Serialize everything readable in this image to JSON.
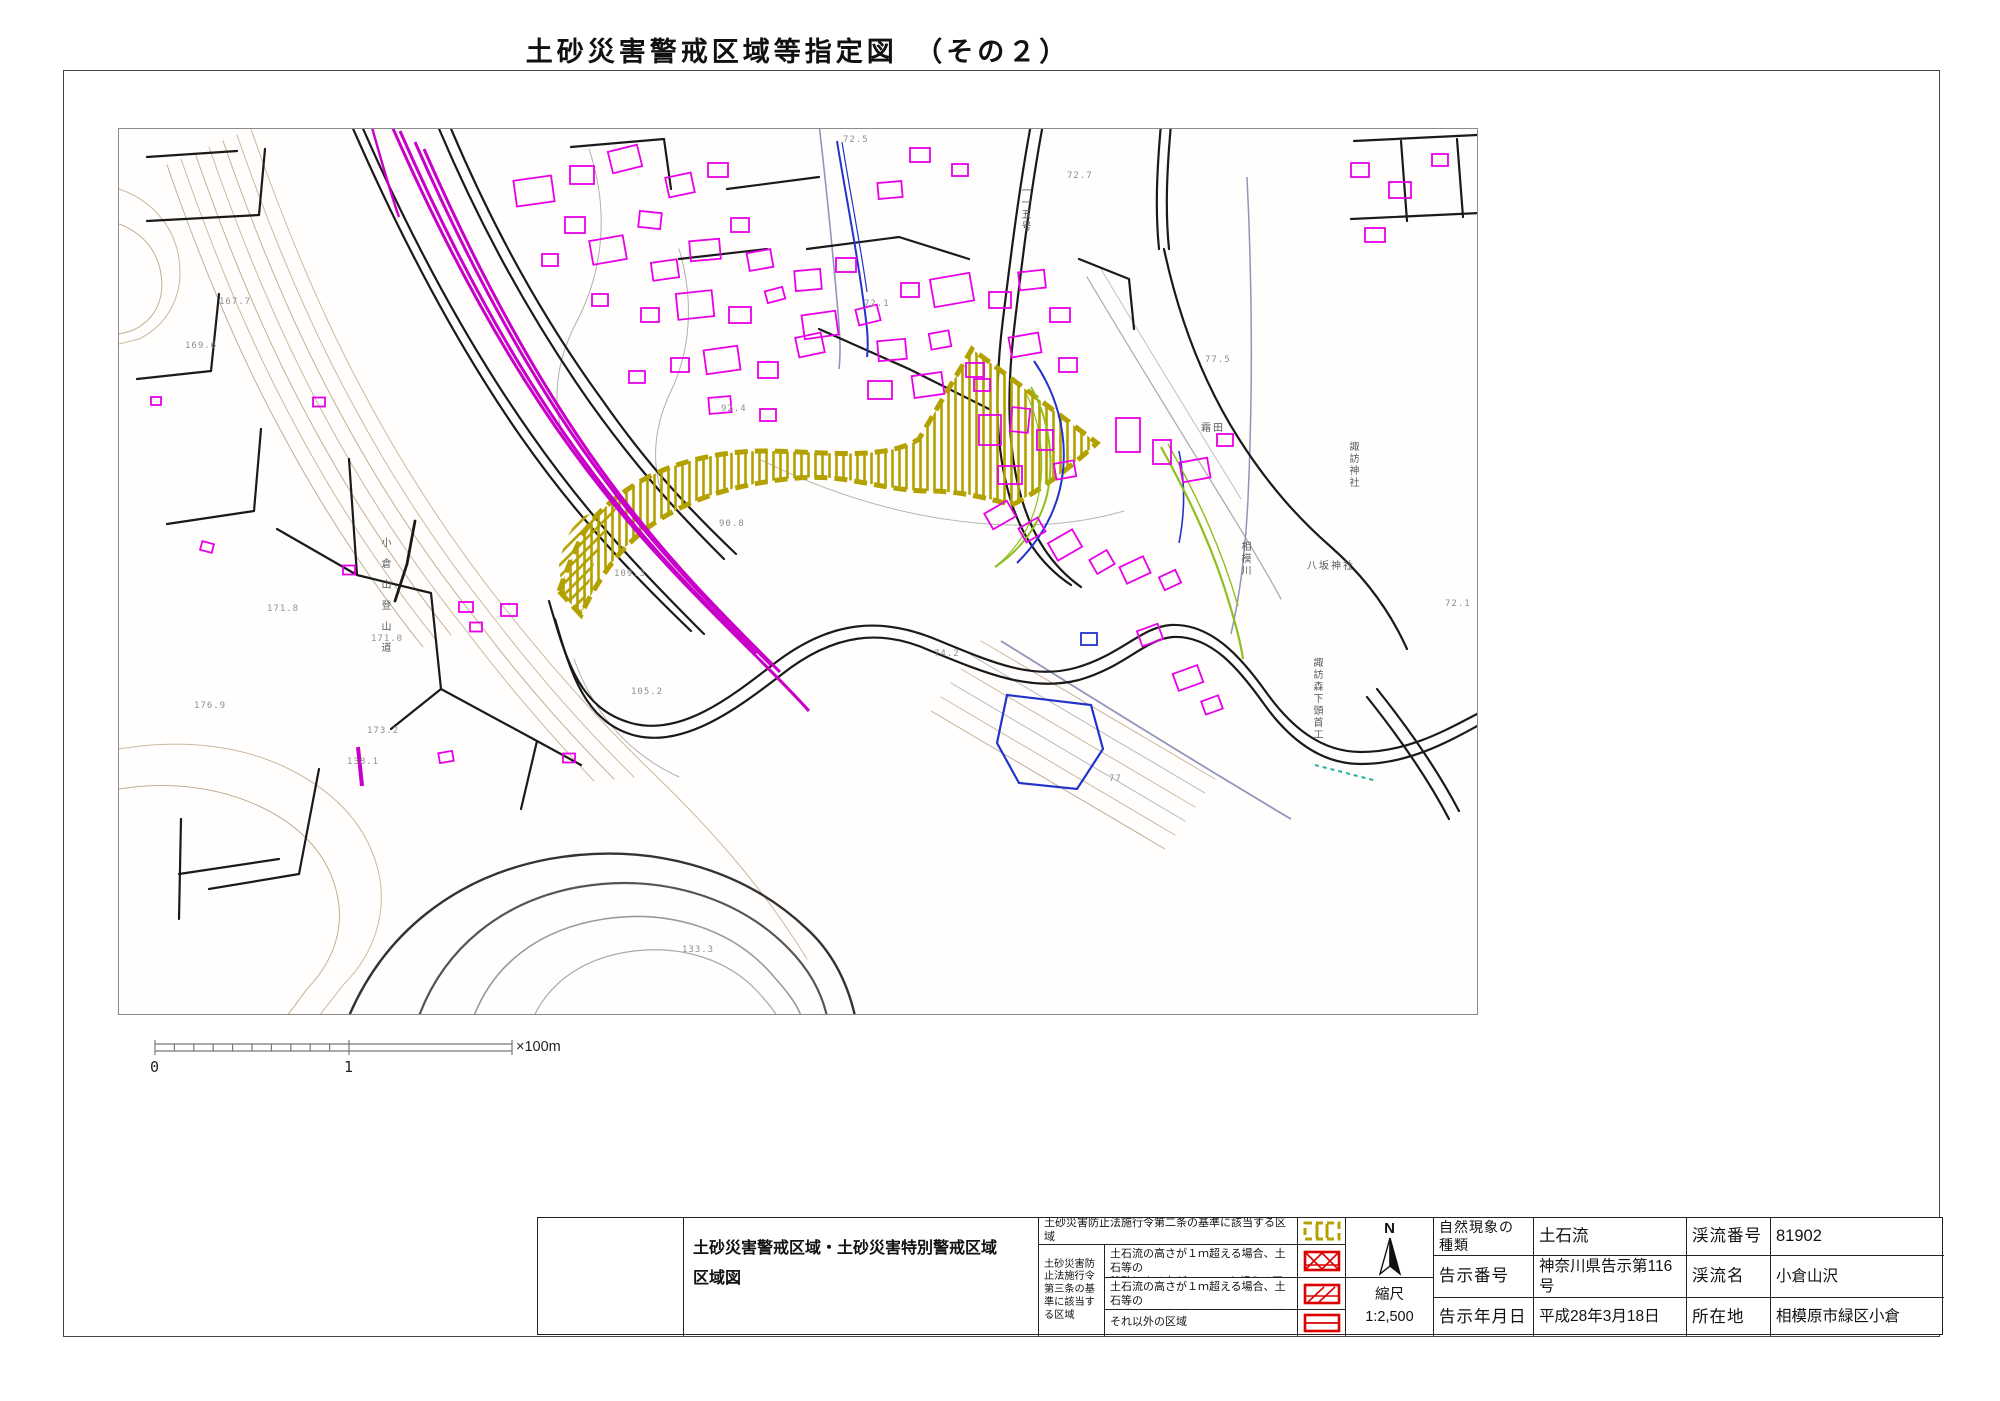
{
  "page": {
    "title": "土砂災害警戒区域等指定図　（その２）"
  },
  "scalebar": {
    "zero": "0",
    "one": "1",
    "unit": "×100m"
  },
  "legend": {
    "doc_title_line1": "土砂災害警戒区域・土砂災害特別警戒区域",
    "doc_title_line2": "区域図",
    "row1": "土砂災害防止法施行令第二条の基準に該当する区域",
    "group": "土砂災害防止法施行令第三条の基準に該当する区域",
    "row2_line1": "土石流の高さが１ｍ超える場合、土石等の",
    "row2_line2": "移動による力が50kN/m²を超える区域",
    "row3_line1": "土石流の高さが１ｍ超える場合、土石等の",
    "row3_line2": "移動による力が50kN/m²以下の区域",
    "row4": "それ以外の区域",
    "swatch_colors": {
      "warning": "#b3a100",
      "special": "#dd0000"
    }
  },
  "compass": {
    "label": "N"
  },
  "scale": {
    "label": "縮尺",
    "value": "1:2,500"
  },
  "info": {
    "r1c1": "自然現象の種類",
    "r1c2": "土石流",
    "r1c3": "渓流番号",
    "r1c4": "81902",
    "r2c1": "告示番号",
    "r2c2": "神奈川県告示第116号",
    "r2c3": "渓流名",
    "r2c4": "小倉山沢",
    "r3c1": "告示年月日",
    "r3c2": "平成28年3月18日",
    "r3c3": "所在地",
    "r3c4": "相模原市緑区小倉"
  },
  "map": {
    "colors": {
      "building": "#e800e8",
      "railway": "#c800c8",
      "hazard": "#b3a100",
      "road": "#1a1a1a",
      "water": "#2233cc",
      "green": "#8fbf1f",
      "contour_tan": "#ccb89e",
      "contour_gray": "#b0b0b0"
    },
    "labels": [
      {
        "t": "167.7",
        "x": 100,
        "y": 168
      },
      {
        "t": "169.6",
        "x": 66,
        "y": 212
      },
      {
        "t": "171.8",
        "x": 148,
        "y": 475
      },
      {
        "t": "171.0",
        "x": 252,
        "y": 505
      },
      {
        "t": "173.2",
        "x": 248,
        "y": 597
      },
      {
        "t": "176.9",
        "x": 75,
        "y": 572
      },
      {
        "t": "138.1",
        "x": 228,
        "y": 628
      },
      {
        "t": "133.3",
        "x": 563,
        "y": 816
      },
      {
        "t": "109.3",
        "x": 495,
        "y": 440
      },
      {
        "t": "105.2",
        "x": 512,
        "y": 558
      },
      {
        "t": "92.4",
        "x": 602,
        "y": 275
      },
      {
        "t": "90.8",
        "x": 600,
        "y": 390
      },
      {
        "t": "74.2",
        "x": 815,
        "y": 520
      },
      {
        "t": "72.1",
        "x": 745,
        "y": 170
      },
      {
        "t": "72.5",
        "x": 724,
        "y": 6
      },
      {
        "t": "72.7",
        "x": 948,
        "y": 42
      },
      {
        "t": "77.5",
        "x": 1086,
        "y": 226
      },
      {
        "t": "72.1",
        "x": 1326,
        "y": 470
      },
      {
        "t": "77",
        "x": 990,
        "y": 645
      },
      {
        "t": "霜田",
        "x": 1082,
        "y": 290,
        "place": 1
      },
      {
        "t": "八坂神社",
        "x": 1188,
        "y": 428,
        "place": 1
      },
      {
        "t": "諏訪神社",
        "x": 1226,
        "y": 312,
        "place": 1,
        "v": 1
      },
      {
        "t": "相模川",
        "x": 1118,
        "y": 412,
        "place": 1,
        "v": 1
      },
      {
        "t": "諏訪森下頭首工",
        "x": 1190,
        "y": 528,
        "place": 1,
        "v": 1
      },
      {
        "t": "小倉山登山道",
        "x": 258,
        "y": 408,
        "place": 1,
        "v": 1,
        "spread": 1
      },
      {
        "t": "一一五号",
        "x": 898,
        "y": 56,
        "place": 1,
        "v": 1
      }
    ],
    "buildings": [
      [
        415,
        62,
        38,
        26,
        -8
      ],
      [
        463,
        46,
        24,
        18,
        0
      ],
      [
        506,
        30,
        30,
        22,
        -14
      ],
      [
        456,
        96,
        20,
        16,
        0
      ],
      [
        489,
        121,
        34,
        24,
        -10
      ],
      [
        531,
        91,
        22,
        16,
        6
      ],
      [
        561,
        56,
        26,
        20,
        -12
      ],
      [
        599,
        41,
        20,
        14,
        0
      ],
      [
        546,
        141,
        26,
        18,
        -8
      ],
      [
        586,
        121,
        30,
        20,
        -5
      ],
      [
        621,
        96,
        18,
        14,
        0
      ],
      [
        641,
        131,
        24,
        18,
        -10
      ],
      [
        576,
        176,
        36,
        26,
        -6
      ],
      [
        621,
        186,
        22,
        16,
        0
      ],
      [
        656,
        166,
        18,
        12,
        -15
      ],
      [
        531,
        186,
        18,
        14,
        0
      ],
      [
        481,
        171,
        16,
        12,
        0
      ],
      [
        431,
        131,
        16,
        12,
        0
      ],
      [
        603,
        231,
        34,
        24,
        -8
      ],
      [
        649,
        241,
        20,
        16,
        0
      ],
      [
        691,
        216,
        26,
        20,
        -12
      ],
      [
        561,
        236,
        18,
        14,
        0
      ],
      [
        601,
        276,
        22,
        16,
        -5
      ],
      [
        649,
        286,
        16,
        12,
        0
      ],
      [
        518,
        248,
        16,
        12,
        0
      ],
      [
        689,
        151,
        26,
        20,
        -5
      ],
      [
        727,
        136,
        20,
        14,
        0
      ],
      [
        701,
        196,
        34,
        24,
        -8
      ],
      [
        749,
        186,
        22,
        16,
        -14
      ],
      [
        791,
        161,
        18,
        14,
        0
      ],
      [
        773,
        221,
        28,
        20,
        -5
      ],
      [
        821,
        211,
        20,
        16,
        -10
      ],
      [
        761,
        261,
        24,
        18,
        0
      ],
      [
        809,
        256,
        30,
        22,
        -8
      ],
      [
        856,
        241,
        18,
        14,
        0
      ],
      [
        833,
        161,
        40,
        28,
        -10
      ],
      [
        881,
        171,
        22,
        16,
        0
      ],
      [
        913,
        151,
        26,
        18,
        -6
      ],
      [
        941,
        186,
        20,
        14,
        0
      ],
      [
        906,
        216,
        30,
        20,
        -10
      ],
      [
        949,
        236,
        18,
        14,
        0
      ],
      [
        801,
        26,
        20,
        14,
        0
      ],
      [
        841,
        41,
        16,
        12,
        0
      ],
      [
        771,
        61,
        24,
        16,
        -5
      ],
      [
        1241,
        41,
        18,
        14,
        0
      ],
      [
        1281,
        61,
        22,
        16,
        0
      ],
      [
        1321,
        31,
        16,
        12,
        0
      ],
      [
        1256,
        106,
        20,
        14,
        0
      ],
      [
        871,
        301,
        22,
        30,
        0
      ],
      [
        901,
        291,
        18,
        24,
        6
      ],
      [
        926,
        311,
        16,
        20,
        0
      ],
      [
        946,
        341,
        20,
        16,
        -10
      ],
      [
        891,
        346,
        24,
        18,
        0
      ],
      [
        863,
        256,
        16,
        12,
        0
      ],
      [
        881,
        386,
        26,
        18,
        -30
      ],
      [
        913,
        401,
        22,
        16,
        -30
      ],
      [
        946,
        416,
        28,
        20,
        -30
      ],
      [
        983,
        433,
        20,
        16,
        -30
      ],
      [
        1016,
        441,
        26,
        18,
        -25
      ],
      [
        1051,
        451,
        18,
        14,
        -25
      ],
      [
        1009,
        306,
        24,
        34,
        0
      ],
      [
        1043,
        323,
        18,
        24,
        0
      ],
      [
        1076,
        341,
        28,
        20,
        -10
      ],
      [
        1106,
        311,
        16,
        12,
        0
      ],
      [
        1031,
        506,
        22,
        16,
        -20
      ],
      [
        1069,
        549,
        26,
        18,
        -20
      ],
      [
        1093,
        576,
        18,
        14,
        -20
      ],
      [
        37,
        272,
        10,
        8,
        0
      ],
      [
        200,
        273,
        12,
        9,
        0
      ],
      [
        88,
        418,
        12,
        9,
        15
      ],
      [
        230,
        441,
        12,
        9,
        0
      ],
      [
        347,
        478,
        14,
        10,
        0
      ],
      [
        390,
        481,
        16,
        12,
        0
      ],
      [
        357,
        498,
        12,
        9,
        0
      ],
      [
        327,
        628,
        14,
        10,
        -10
      ],
      [
        450,
        629,
        12,
        9,
        0
      ]
    ]
  }
}
